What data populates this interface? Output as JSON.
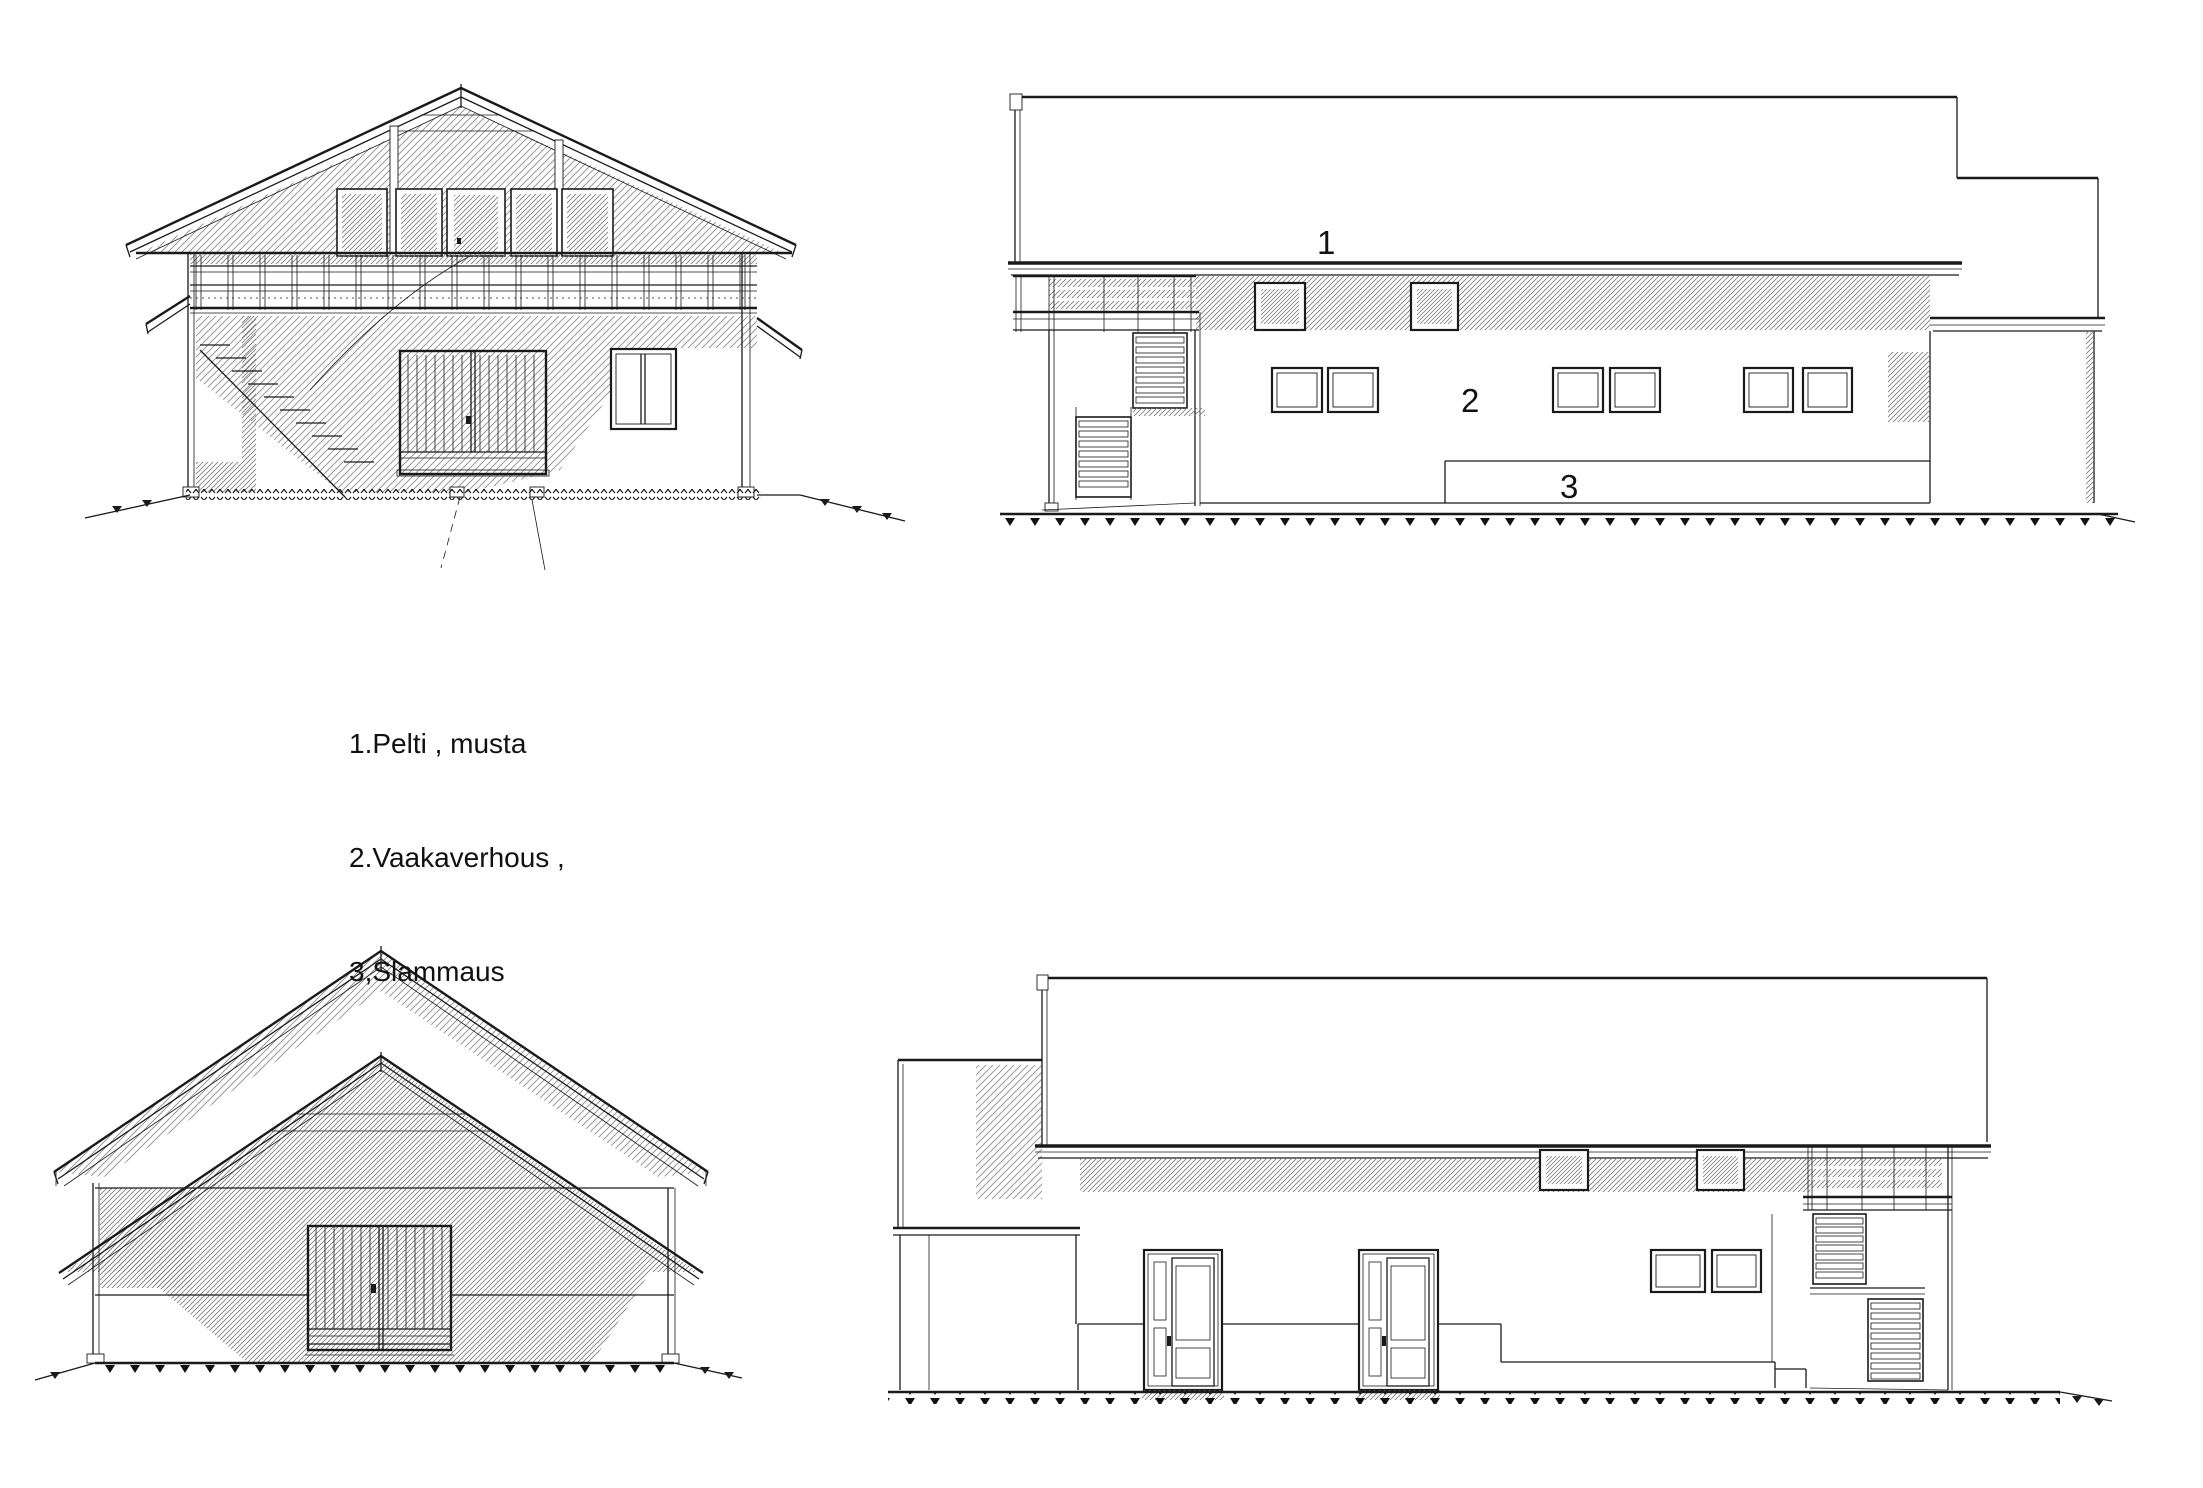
{
  "sheet": {
    "background_color": "#ffffff",
    "line_color": "#1a1a1a",
    "hatch_color": "#888888"
  },
  "legend": {
    "items": [
      {
        "text": "1.Pelti , musta"
      },
      {
        "text": "2.Vaakaverhous ,"
      },
      {
        "text": "3,Slammaus"
      }
    ]
  },
  "markers": [
    {
      "number": "1"
    },
    {
      "number": "2"
    },
    {
      "number": "3"
    }
  ],
  "views": [
    {
      "name": "gable-end-section"
    },
    {
      "name": "side-elevation-right"
    },
    {
      "name": "gable-end-elevation"
    },
    {
      "name": "side-elevation-left"
    }
  ]
}
